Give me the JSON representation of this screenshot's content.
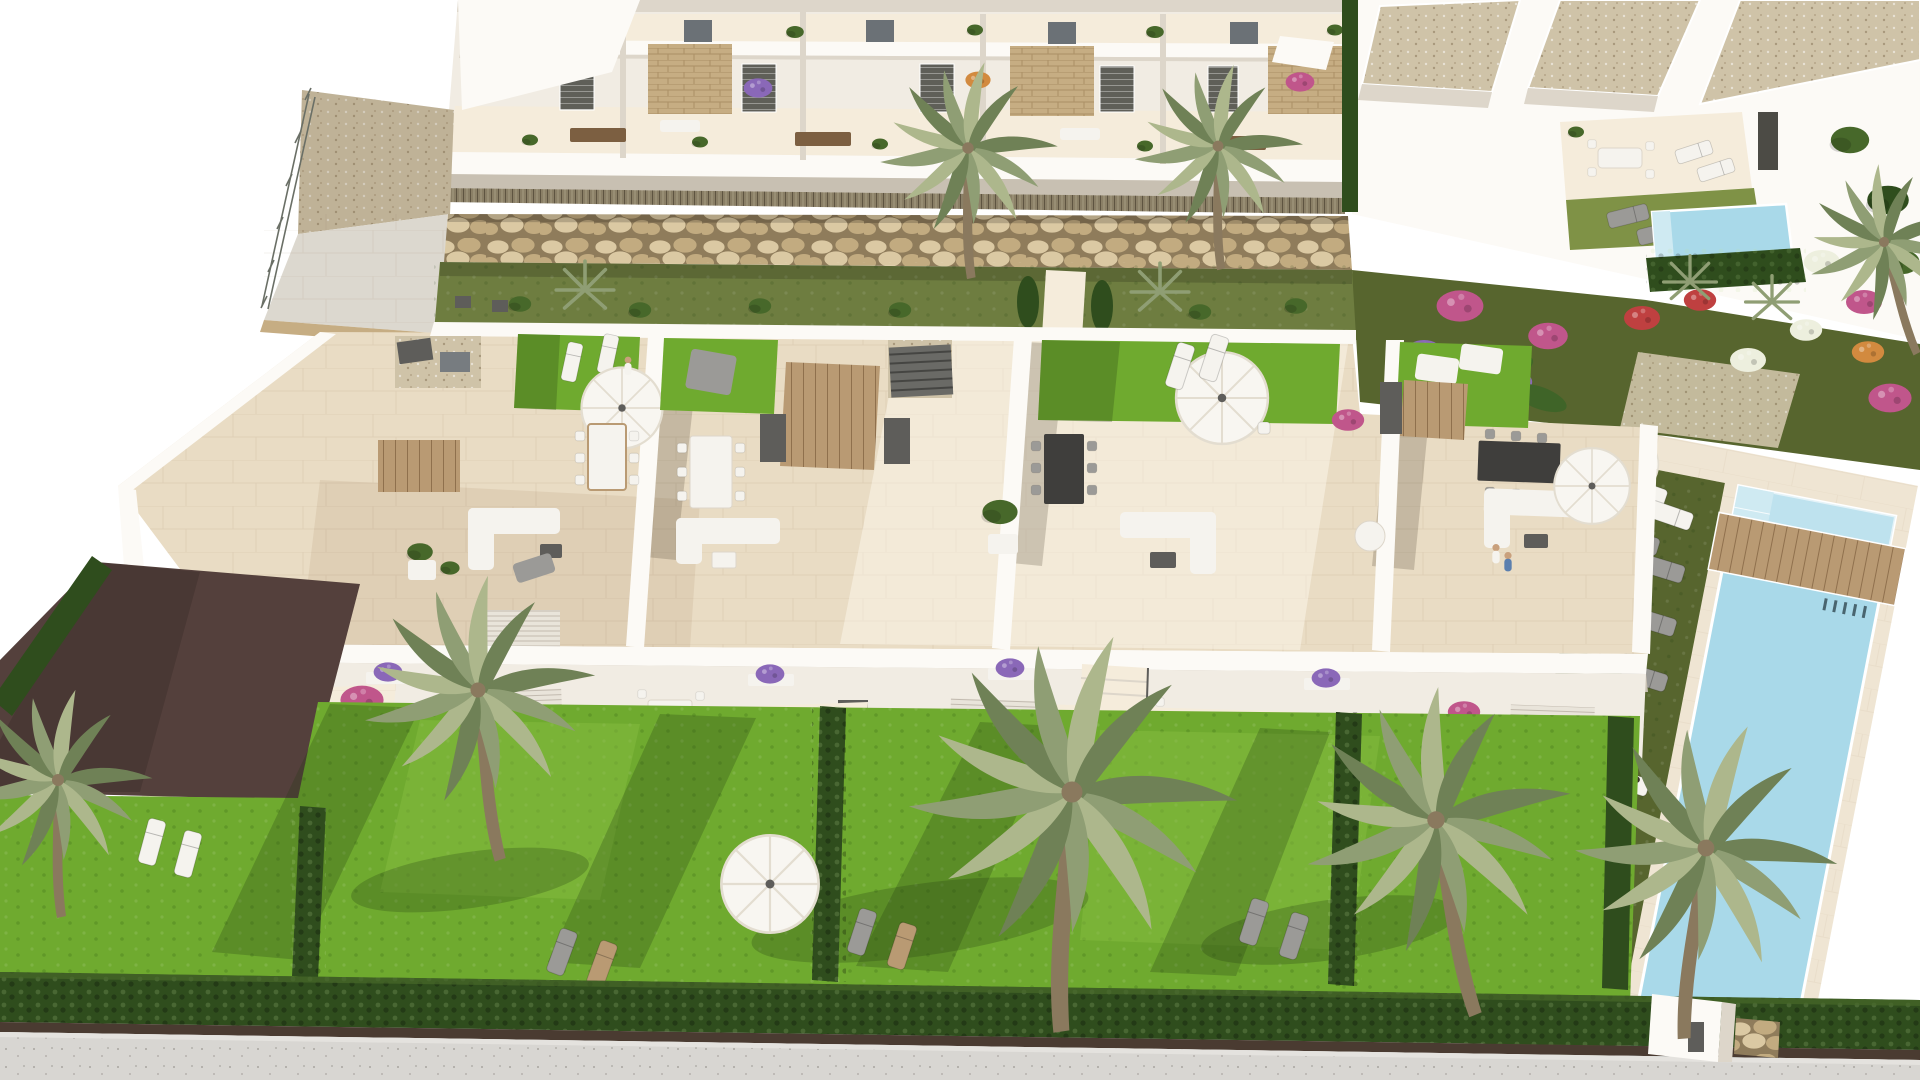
{
  "scene": {
    "type": "architectural-aerial-render",
    "description": "Aerial 3D visualisation of a Mediterranean residential development: a rear row of white two-storey apartments with balconies and stone-clad accents above a gabion rock retaining wall, a central row of townhouses with furnished rooftop solariums (lawns, parasols, dining sets, sofas), private gardens with tall palm trees and clipped hedges, a long communal swimming pool with sun loungers on the right, a detached villa zone with a private plunge pool at the top right, and a grey sidewalk along the bottom edge.",
    "visible_text": [],
    "features": [
      "apartment-terraces",
      "gabion-stone-wall",
      "rooftop-solariums",
      "communal-pool",
      "private-plunge-pool",
      "palm-trees",
      "ornamental-flower-garden",
      "private-lawns",
      "sun-loungers",
      "parasols",
      "outdoor-dining-sets",
      "access-ramp",
      "sidewalk"
    ],
    "palette": {
      "bg": "#ffffff",
      "wall": "#f1ece3",
      "wall_bright": "#fcfaf6",
      "wall_shade": "#ddd6ca",
      "wall_dark": "#c8c0b2",
      "floor_cream": "#e9dcc4",
      "floor_light": "#f5ecdb",
      "floor_shade": "#d9c6a8",
      "stone": "#c6ad83",
      "rock_light": "#dbc9a3",
      "rock_mid": "#c2ab80",
      "rock_dark": "#8f7c5b",
      "gravel": "#cfc3a8",
      "bamboo": "#8a7f66",
      "grass_olive": "#6e7d40",
      "grass_olive_dark": "#57652e",
      "grass_villa": "#7f9246",
      "grass_bright": "#6faa2f",
      "grass_light": "#85bb3f",
      "hedge": "#2f4d1d",
      "hedge_light": "#47682a",
      "palm_light": "#adb78c",
      "palm_mid": "#8f9e74",
      "palm_dark": "#6f8156",
      "trunk": "#8a795e",
      "pool_water": "#a9d9e9",
      "pool_deep": "#7fc3da",
      "pool_step": "#cfeaf2",
      "deck": "#efe5d3",
      "sidewalk": "#d8d6d2",
      "soil": "#4a3b31",
      "path_plum": "#54403c",
      "furn_white": "#f5f3ee",
      "furn_gray": "#9b9a97",
      "furn_dark": "#5e5d5a",
      "wood": "#b99a73",
      "wood_dark": "#7c5f41",
      "table_black": "#3f3e3c",
      "parasol": "#f8f6f1",
      "parasol_shade": "#e3ddd0",
      "flower_magenta": "#c0568b",
      "flower_purple": "#8a68b8",
      "flower_red": "#bf4040",
      "flower_orange": "#d28a3f",
      "flower_white": "#edefde",
      "banana": "#3f6428",
      "skin": "#c9a07c",
      "shirt_blue": "#5b7fae",
      "shadow": "rgba(70,60,40,0.22)",
      "shadow_green": "rgba(30,55,15,0.25)"
    }
  }
}
